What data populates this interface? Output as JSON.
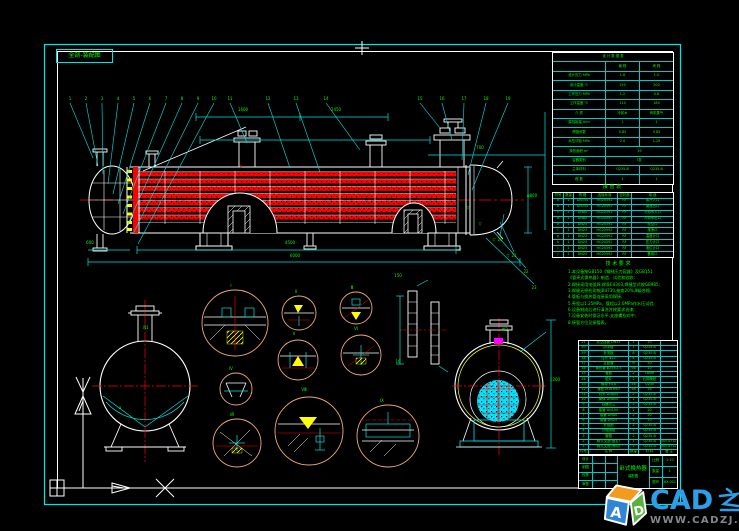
{
  "meta": {
    "view_label": "全剖-装配图"
  },
  "colors": {
    "line_cyan": "#00ffff",
    "line_white": "#ffffff",
    "tube_red": "#ff0000",
    "text_green": "#00ff00",
    "detail_circle_tan": "#f0a878",
    "hatch_yellow": "#ffff00",
    "marker_magenta": "#ff00ff",
    "brand_blue": "#2ba0e8",
    "url_gray": "#84898e"
  },
  "watermark": {
    "brand": "CAD之家",
    "brand_latin": "CAD",
    "brand_cjk": "之家",
    "url": "WWW.CADZJ.COM",
    "logo_letters": "AD"
  },
  "design_table": {
    "title": "设 计 数 据 表",
    "rows": [
      [
        "设 计 数 据 表"
      ],
      [
        "",
        "管 程",
        "壳 程"
      ],
      [
        "设计压力 MPa",
        "1.6",
        "1.0"
      ],
      [
        "设计温度 ℃",
        "150",
        "200"
      ],
      [
        "工作压力 MPa",
        "1.2",
        "0.8"
      ],
      [
        "工作温度 ℃",
        "110",
        "180"
      ],
      [
        "介 质",
        "冷却水",
        "有机蒸气"
      ],
      [
        "腐蚀裕量 mm",
        "1",
        "1"
      ],
      [
        "焊缝系数",
        "0.85",
        "0.85"
      ],
      [
        "水压试验 MPa",
        "2.0",
        "1.25"
      ],
      [
        "换热面积 m²",
        "55"
      ],
      [
        "容器类别",
        "Ⅰ类"
      ],
      [
        "主体材料",
        "Q235-B",
        "Q235-B"
      ],
      [
        "程 数",
        "2",
        "1"
      ]
    ]
  },
  "nozzle_table": {
    "title": "接 管 表",
    "rows": [
      [
        "符号",
        "数量",
        "规 格",
        "连接标准",
        "密封面",
        "用 途"
      ],
      [
        "a",
        "1",
        "DN150",
        "HG20592",
        "RF",
        "蒸汽入口"
      ],
      [
        "b",
        "1",
        "DN150",
        "HG20592",
        "RF",
        "凝液出口"
      ],
      [
        "c",
        "1",
        "DN80",
        "HG20592",
        "RF",
        "冷却水入口"
      ],
      [
        "d",
        "1",
        "DN80",
        "HG20592",
        "RF",
        "冷却水出口"
      ],
      [
        "e",
        "1",
        "DN25",
        "HG20592",
        "RF",
        "放空口"
      ],
      [
        "f",
        "1",
        "DN25",
        "HG20592",
        "RF",
        "排净口"
      ],
      [
        "g",
        "1",
        "DN25",
        "HG20592",
        "RF",
        "温度计口"
      ],
      [
        "h",
        "1",
        "DN25",
        "HG20592",
        "RF",
        "压力计口"
      ],
      [
        "i",
        "1",
        "DN25",
        "HG20592",
        "RF",
        "液位计口"
      ],
      [
        "j",
        "1",
        "DN20",
        "HG20592",
        "RF",
        "备用口"
      ]
    ]
  },
  "notes": {
    "title": "技 术 要 求",
    "lines": [
      "1.本设备按GB150《钢制压力容器》及GB151",
      "  《管壳式换热器》制造、试验和验收;",
      "2.焊接采用电弧焊,焊条E4303,焊缝型式按GB985;",
      "3.焊缝无损检测按JB4730,抽查20%,Ⅲ级合格;",
      "4.管板与换热管连接采用焊接;",
      "5.壳程以1.25MPa、管程以2.0MPa作水压试验;",
      "6.设备制成后进行清洗并按要求油漆;",
      "7.设备安装时保证水平,支座螺栓对中;",
      "8.接管方位见接管表。"
    ]
  },
  "bom": {
    "rows": [
      [
        "21",
        "放空接管 DN25",
        "1",
        "20",
        ""
      ],
      [
        "20",
        "防冲板",
        "1",
        "Q235-B",
        ""
      ],
      [
        "19",
        "折流板",
        "8",
        "Q235-B",
        ""
      ],
      [
        "18",
        "拉杆 φ12",
        "6",
        "Q235-B",
        ""
      ],
      [
        "17",
        "定距管",
        "6",
        "20",
        ""
      ],
      [
        "16",
        "换热管 φ25×2.5",
        "98",
        "10",
        ""
      ],
      [
        "15",
        "管板",
        "2",
        "16Mn",
        ""
      ],
      [
        "14",
        "垫片",
        "2",
        "石棉橡胶",
        ""
      ],
      [
        "13",
        "螺母 M16",
        "56",
        "Q235",
        ""
      ],
      [
        "12",
        "螺栓 M16×60",
        "56",
        "35",
        ""
      ],
      [
        "11",
        "封头 DN800",
        "2",
        "Q235-B",
        ""
      ],
      [
        "10",
        "筒体 DN800",
        "1",
        "Q235-B",
        ""
      ],
      [
        "9",
        "容器法兰",
        "2",
        "Q235-B",
        ""
      ],
      [
        "8",
        "接管 DN150",
        "2",
        "20",
        ""
      ],
      [
        "7",
        "接管 DN80",
        "2",
        "20",
        ""
      ],
      [
        "6",
        "接管 DN25",
        "4",
        "20",
        ""
      ],
      [
        "5",
        "补强圈",
        "2",
        "Q235-B",
        ""
      ],
      [
        "4",
        "分程隔板",
        "1",
        "Q235-B",
        ""
      ],
      [
        "3",
        "管箱",
        "2",
        "Q235-B",
        ""
      ],
      [
        "2",
        "鞍式支座(固定)",
        "1",
        "Q235-B",
        "JB/T4712"
      ],
      [
        "1",
        "鞍式支座(滑动)",
        "1",
        "Q235-B",
        "JB/T4712"
      ],
      [
        "件号",
        "名 称",
        "数量",
        "材 料",
        "备 注"
      ]
    ]
  },
  "titleblock": {
    "title": "卧式换热器",
    "subtitle": "装配图",
    "left_rows": [
      [
        "设计",
        "",
        ""
      ],
      [
        "制图",
        "",
        ""
      ],
      [
        "校核",
        "",
        ""
      ],
      [
        "审核",
        "",
        ""
      ]
    ],
    "right_rows": [
      [
        "比例",
        "1:10"
      ],
      [
        "数量",
        "1"
      ],
      [
        "图号",
        "HX-001"
      ]
    ]
  },
  "marks": {
    "labels": [
      {
        "x": 70,
        "y": 99,
        "t": "1"
      },
      {
        "x": 86,
        "y": 99,
        "t": "2"
      },
      {
        "x": 102,
        "y": 99,
        "t": "3"
      },
      {
        "x": 118,
        "y": 99,
        "t": "4"
      },
      {
        "x": 134,
        "y": 99,
        "t": "5"
      },
      {
        "x": 150,
        "y": 99,
        "t": "6"
      },
      {
        "x": 166,
        "y": 99,
        "t": "7"
      },
      {
        "x": 182,
        "y": 99,
        "t": "8"
      },
      {
        "x": 198,
        "y": 99,
        "t": "9"
      },
      {
        "x": 214,
        "y": 99,
        "t": "10"
      },
      {
        "x": 230,
        "y": 99,
        "t": "11"
      },
      {
        "x": 268,
        "y": 99,
        "t": "12"
      },
      {
        "x": 296,
        "y": 99,
        "t": "13"
      },
      {
        "x": 326,
        "y": 99,
        "t": "14"
      },
      {
        "x": 420,
        "y": 99,
        "t": "15"
      },
      {
        "x": 442,
        "y": 99,
        "t": "16"
      },
      {
        "x": 464,
        "y": 99,
        "t": "17"
      },
      {
        "x": 486,
        "y": 99,
        "t": "18"
      },
      {
        "x": 508,
        "y": 99,
        "t": "19"
      },
      {
        "x": 500,
        "y": 240,
        "t": "20"
      },
      {
        "x": 514,
        "y": 256,
        "t": "21"
      },
      {
        "x": 526,
        "y": 272,
        "t": "22"
      },
      {
        "x": 534,
        "y": 288,
        "t": "23"
      },
      {
        "x": 243,
        "y": 110,
        "t": "1600"
      },
      {
        "x": 336,
        "y": 110,
        "t": "2450"
      },
      {
        "x": 480,
        "y": 148,
        "t": "700"
      },
      {
        "x": 290,
        "y": 243,
        "t": "4500"
      },
      {
        "x": 295,
        "y": 256,
        "t": "6000"
      },
      {
        "x": 90,
        "y": 243,
        "t": "600"
      },
      {
        "x": 532,
        "y": 196,
        "t": "φ800"
      },
      {
        "x": 555,
        "y": 380,
        "t": "1200"
      },
      {
        "x": 398,
        "y": 276,
        "t": "150"
      },
      {
        "x": 398,
        "y": 362,
        "t": "16"
      },
      {
        "x": 231,
        "y": 286,
        "t": "Ⅰ"
      },
      {
        "x": 296,
        "y": 292,
        "t": "Ⅱ"
      },
      {
        "x": 352,
        "y": 288,
        "t": "Ⅲ"
      },
      {
        "x": 231,
        "y": 369,
        "t": "Ⅳ"
      },
      {
        "x": 294,
        "y": 334,
        "t": "Ⅴ"
      },
      {
        "x": 356,
        "y": 329,
        "t": "Ⅵ"
      },
      {
        "x": 232,
        "y": 415,
        "t": "Ⅶ"
      },
      {
        "x": 304,
        "y": 390,
        "t": "Ⅷ"
      },
      {
        "x": 382,
        "y": 401,
        "t": "Ⅸ"
      },
      {
        "x": 146,
        "y": 328,
        "t": "N1"
      },
      {
        "x": 120,
        "y": 408,
        "t": "a"
      },
      {
        "x": 505,
        "y": 330,
        "t": "N2"
      },
      {
        "x": 468,
        "y": 208,
        "t": "▽"
      },
      {
        "x": 480,
        "y": 224,
        "t": "▽"
      },
      {
        "x": 494,
        "y": 240,
        "t": "▽"
      },
      {
        "x": 508,
        "y": 256,
        "t": "▽"
      },
      {
        "x": 460,
        "y": 250,
        "t": "▽"
      }
    ]
  }
}
